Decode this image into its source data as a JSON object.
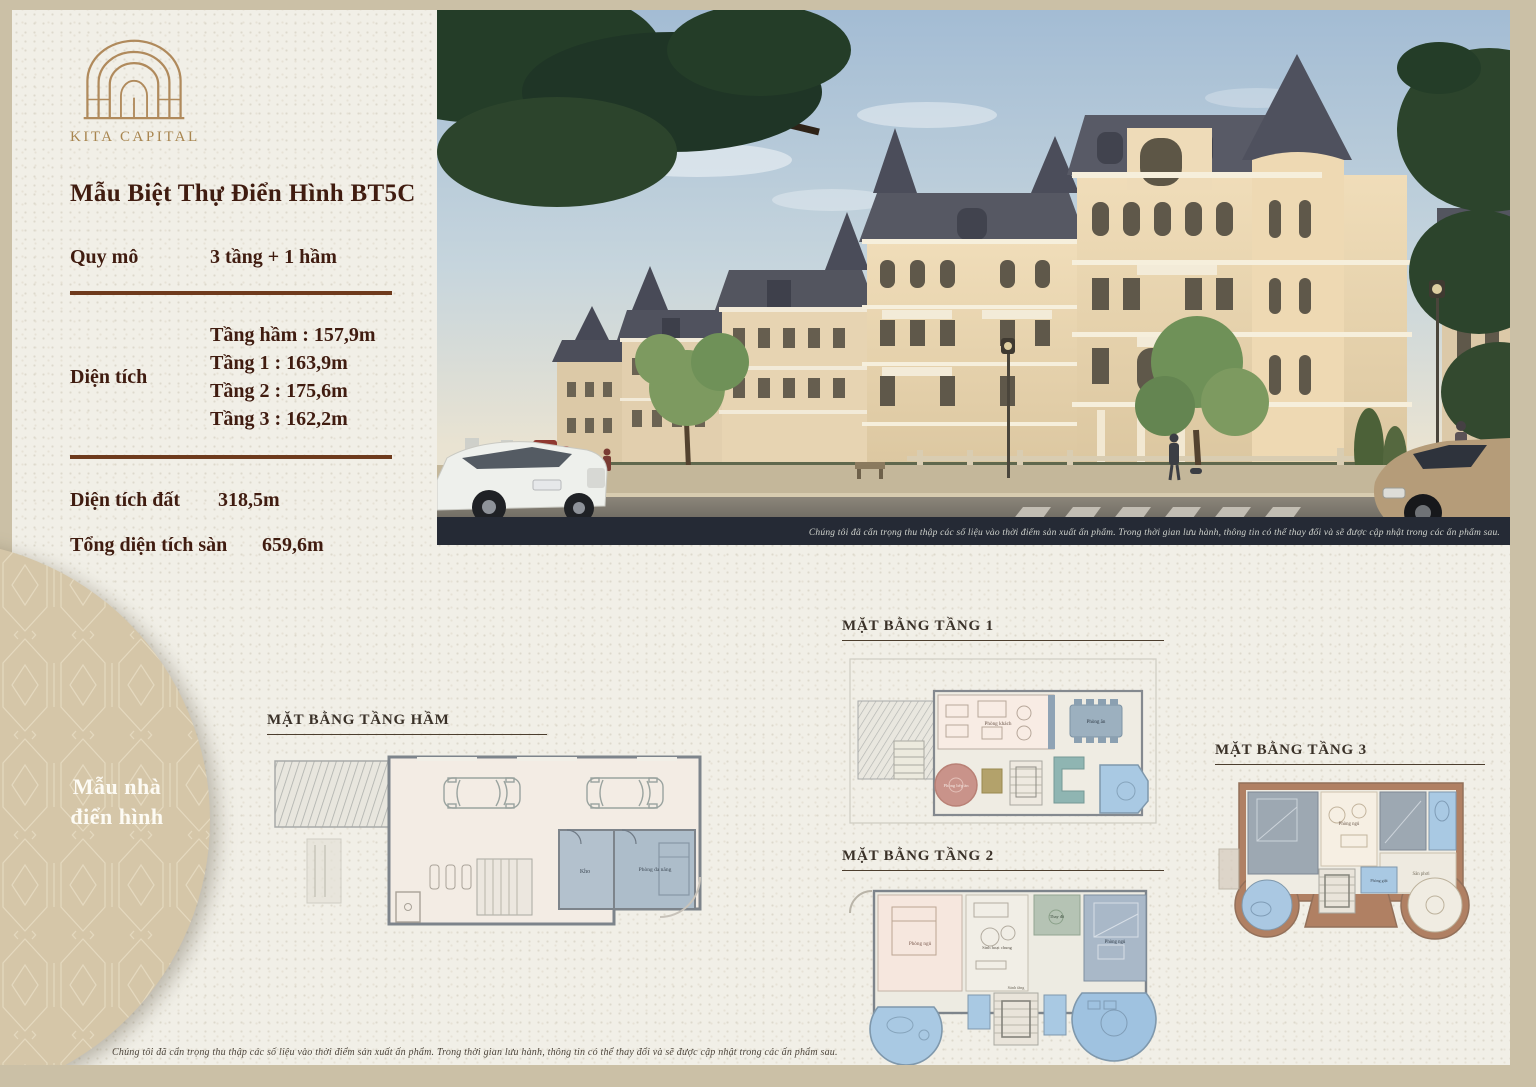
{
  "brand": "KITA CAPITAL",
  "info": {
    "title": "Mẫu Biệt Thự Điển Hình BT5C",
    "specs": [
      {
        "label": "Quy mô",
        "value": "3 tầng + 1 hầm"
      },
      {
        "label": "Diện tích",
        "values": [
          "Tầng hầm : 157,9m",
          "Tầng 1 : 163,9m",
          "Tầng 2 : 175,6m",
          "Tầng 3 : 162,2m"
        ]
      },
      {
        "label": "Diện tích đất",
        "value": "318,5m"
      },
      {
        "label": "Tổng diện tích sàn",
        "value": "659,6m"
      }
    ]
  },
  "photo": {
    "caption": "Chúng tôi đã cẩn trọng thu thập các số liệu vào thời điểm sản xuất ấn phẩm. Trong thời gian lưu hành, thông tin có thể thay đổi và sẽ được cập nhật trong các ấn phẩm sau."
  },
  "plans": {
    "basement": {
      "title": "MẶT BẰNG TẦNG HẦM",
      "rooms": [
        "Kho",
        "Phòng đa năng"
      ]
    },
    "floor1": {
      "title": "MẶT BẰNG TẦNG 1",
      "rooms": [
        "Phòng khách",
        "Phòng ăn",
        "Phòng bếp ăn"
      ]
    },
    "floor2": {
      "title": "MẶT BẰNG TẦNG 2",
      "rooms": [
        "Phòng ngủ",
        "Sinh hoạt chung",
        "Thay đồ",
        "Phòng ngủ",
        "Sảnh tầng"
      ]
    },
    "floor3": {
      "title": "MẶT BẰNG TẦNG 3",
      "rooms": [
        "Phòng ngủ",
        "Phòng giặt",
        "Sân phơi"
      ]
    }
  },
  "badge": {
    "line1": "Mẫu nhà",
    "line2": "điển hình"
  },
  "footer": {
    "note": "Chúng tôi đã cẩn trọng thu thập các số liệu vào thời điểm sản xuất ấn phẩm. Trong thời gian lưu hành, thông tin có thể thay đổi và sẽ được cập nhật trong các ấn phẩm sau."
  },
  "colors": {
    "frame": "#cbc0a6",
    "paper": "#f1efe7",
    "heading": "#401c10",
    "divider": "#6e3a1c",
    "brand_bronze": "#a8854f",
    "badge_circle": "#d5c6a8",
    "plan_bath_blue": "#a9c9e3",
    "plan_terrace_brown": "#b08063"
  }
}
